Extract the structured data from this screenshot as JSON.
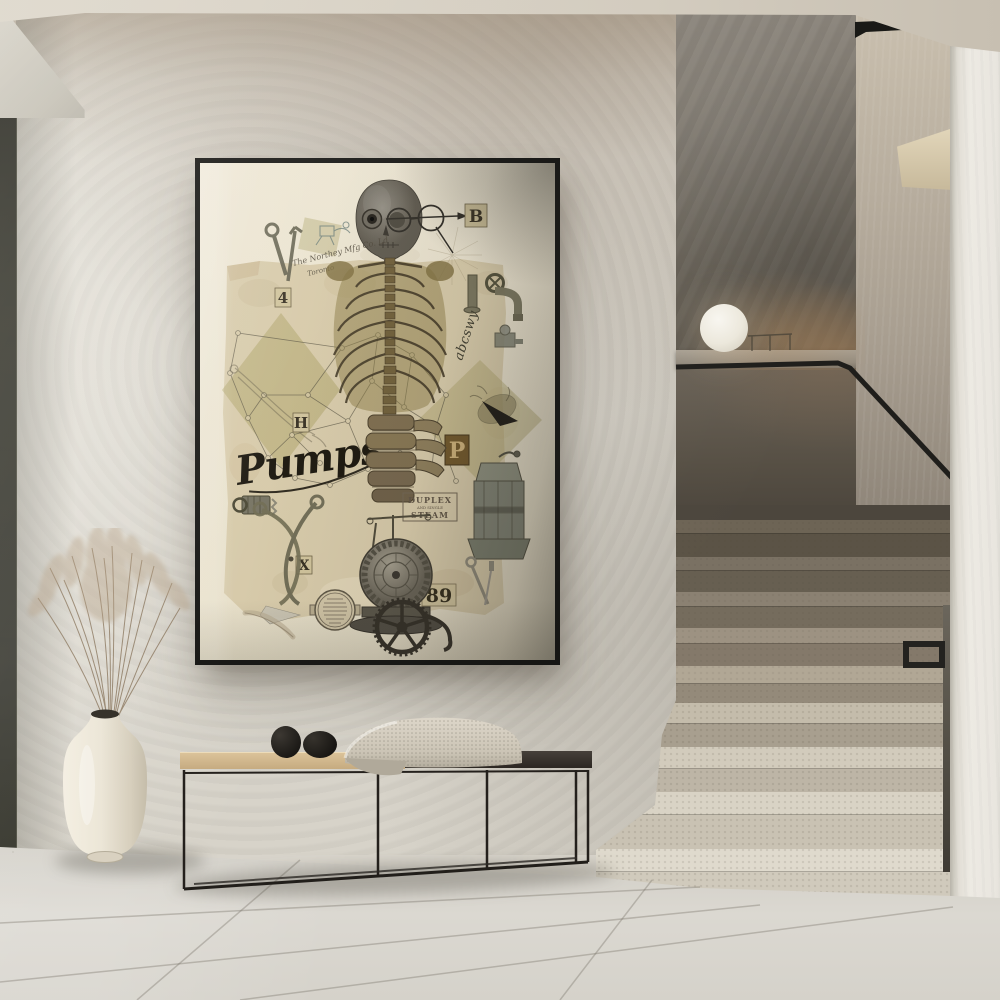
{
  "poster": {
    "script_title": "Pumps",
    "tiles": {
      "b": "B",
      "four": "4",
      "h": "H",
      "p": "P",
      "x": "X",
      "num": "89"
    },
    "stamp": {
      "l1": "DUPLEX",
      "l2": "AND SINGLE",
      "l3": "STEAM"
    },
    "handwriting_maker": "The Northey Mfg Co. Ld",
    "handwriting_city": "Toronto",
    "handwriting_alpha": "abcswy",
    "colors": {
      "frame": "#151513",
      "mat": "#ece5d2",
      "paper": "#d6c9a8",
      "khaki": "#a89d61",
      "ochre": "#8a7a42",
      "ink": "#2e2a20",
      "tile": "#cfc29a"
    }
  },
  "room": {
    "colors": {
      "ceiling": "#d6d0c4",
      "wall": "#d8d4cb",
      "feature_wall": "#746e64",
      "door_panel": "#34342c",
      "stair_dark": "#6d6455",
      "stair_light": "#d9d3c5",
      "floor": "#d6d3cb",
      "bench_wood": "#d2b98e",
      "bench_metal": "#211e1a",
      "vase": "#ece6d7",
      "grass": "#b29c80",
      "lamp": "#f2efe7",
      "handrail": "#1f1e1b",
      "white_wall": "#ebe8e1"
    }
  }
}
